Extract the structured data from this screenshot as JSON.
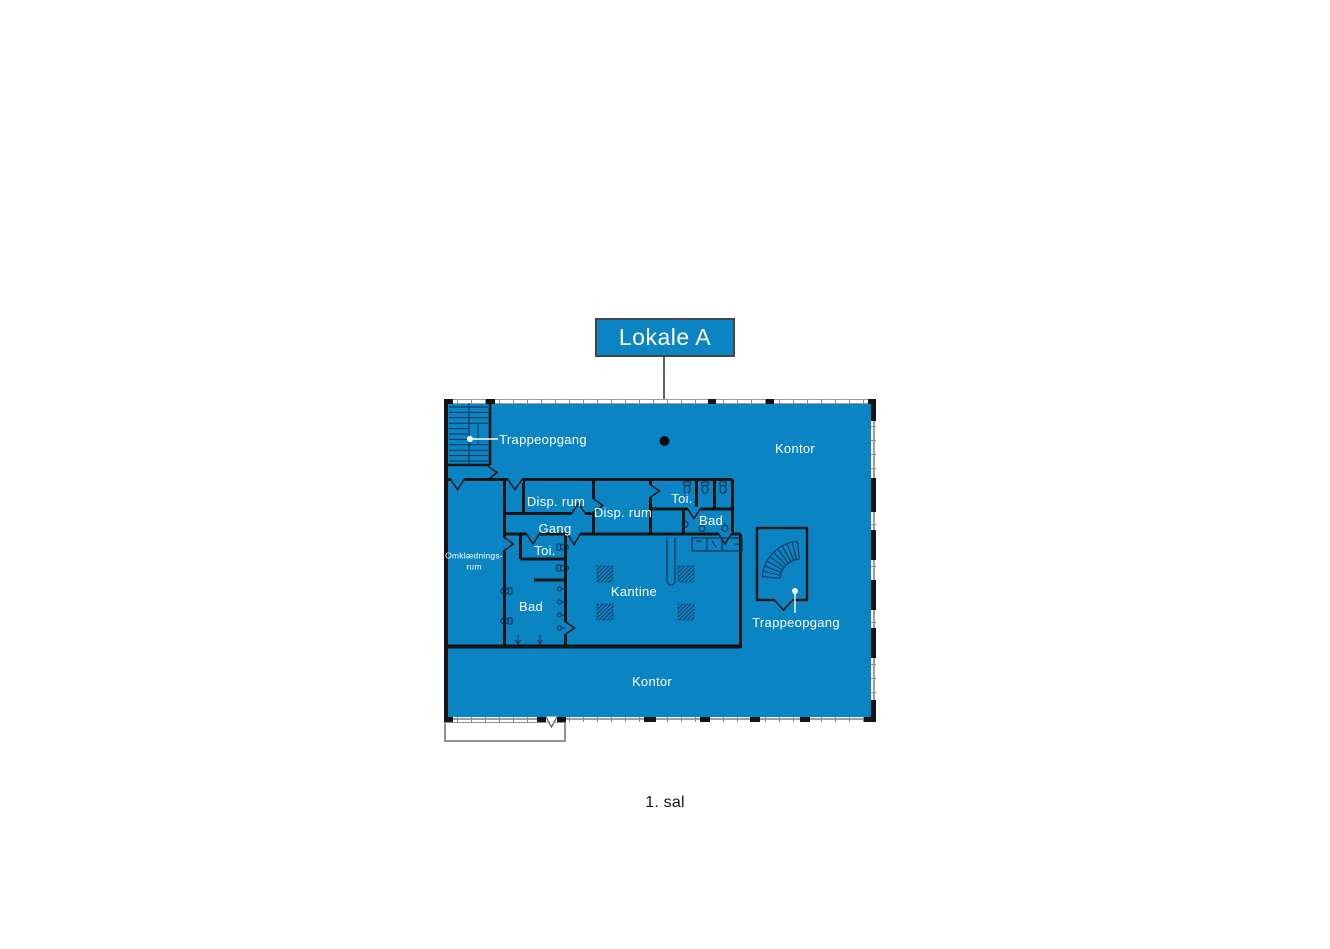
{
  "title_label": {
    "text": "Lokale A"
  },
  "caption": {
    "text": "1. sal"
  },
  "colors": {
    "plan_fill": "#0b84c4",
    "wall": "#141414",
    "window_frame": "#9e9e9e",
    "label_text": "#ffffff",
    "leader_line": "#5f5f5f",
    "caption_text": "#161616",
    "fixture_line": "#0e3150"
  },
  "plan": {
    "labels": {
      "trappeopgang_top": "Trappeopgang",
      "kontor_top": "Kontor",
      "disp_rum_left": "Disp. rum",
      "disp_rum_right": "Disp. rum",
      "toi_upper_right": "Toi.",
      "bad_upper_right": "Bad",
      "gang": "Gang",
      "toi_left": "Toi.",
      "omklaedningsrum_line1": "Omklædnings-",
      "omklaedningsrum_line2": "rum",
      "bad_left": "Bad",
      "kantine": "Kantine",
      "trappeopgang_right": "Trappeopgang",
      "kontor_bottom": "Kontor"
    }
  }
}
